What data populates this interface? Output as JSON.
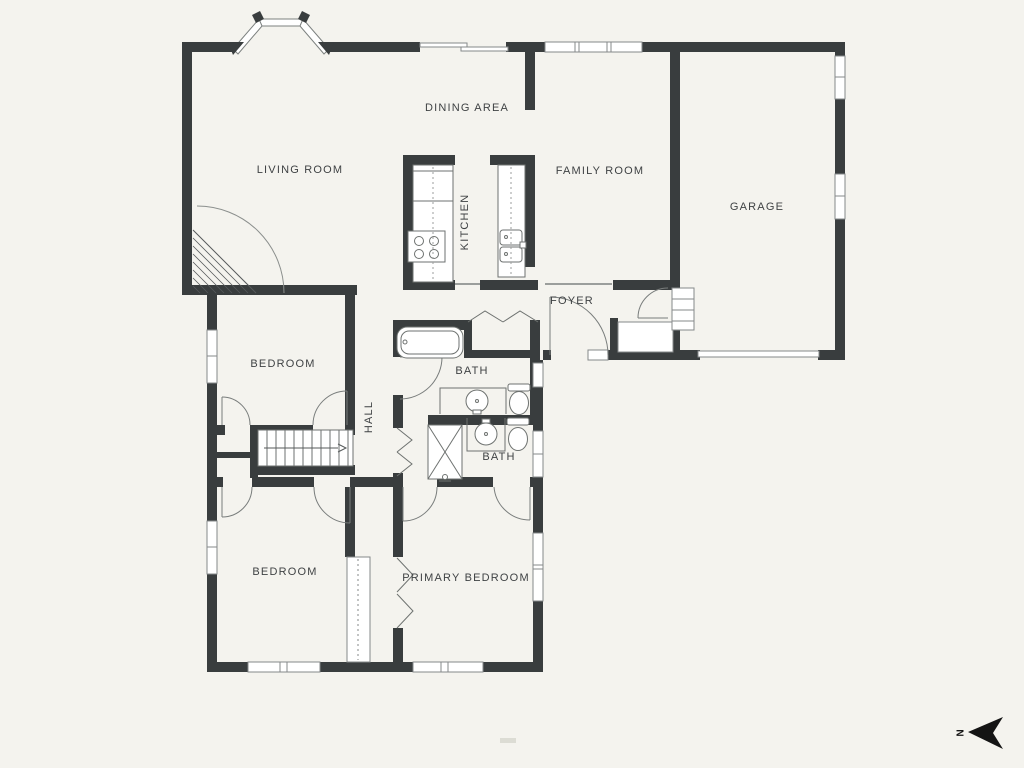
{
  "plan": {
    "wall_color": "#393d3e",
    "background_color": "#f4f3ee",
    "thin_line_color": "#75797a",
    "label_color": "#3f4244",
    "rooms": [
      {
        "id": "living-room",
        "label": "LIVING ROOM"
      },
      {
        "id": "dining-area",
        "label": "DINING AREA"
      },
      {
        "id": "kitchen",
        "label": "KITCHEN",
        "orientation": "vertical"
      },
      {
        "id": "family-room",
        "label": "FAMILY ROOM"
      },
      {
        "id": "garage",
        "label": "GARAGE"
      },
      {
        "id": "foyer",
        "label": "FOYER"
      },
      {
        "id": "bedroom-upper",
        "label": "BEDROOM"
      },
      {
        "id": "bath-upper",
        "label": "BATH"
      },
      {
        "id": "hall",
        "label": "HALL",
        "orientation": "vertical"
      },
      {
        "id": "bath-lower",
        "label": "BATH"
      },
      {
        "id": "bedroom-lower",
        "label": "BEDROOM"
      },
      {
        "id": "primary-bedroom",
        "label": "PRIMARY BEDROOM"
      }
    ],
    "compass": {
      "label": "N",
      "arrow_points": "west"
    },
    "fixtures": [
      "bay-window",
      "sliding-door",
      "fireplace",
      "stairs",
      "bathtub",
      "shower",
      "toilet",
      "sink-vanity",
      "stove",
      "refrigerator",
      "kitchen-sink",
      "garage-door",
      "bifold-closet-doors",
      "wardrobe",
      "entry-steps"
    ]
  }
}
